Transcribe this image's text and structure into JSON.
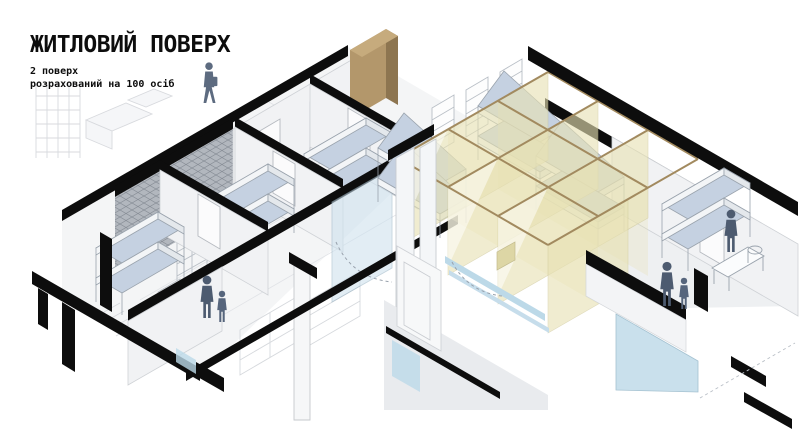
{
  "header": {
    "title": "ЖИТЛОВИЙ ПОВЕРХ",
    "subtitle_line1": "2 поверх",
    "subtitle_line2": "розрахований на 100 осіб"
  },
  "palette": {
    "ink": "#0d0d0d",
    "wall_light": "#f1f2f4",
    "wall_shade": "#e3e5e9",
    "hatch_base": "#b2b7be",
    "mattress": "#c5d1e1",
    "bed_frame": "#f3f5f7",
    "bed_side": "#e4e8ec",
    "fabric_yellow": "#e8e2b4",
    "rail_brown": "#a28a5f",
    "wood_brown": "#b3976b",
    "wood_dark": "#8d7550",
    "glass_blue": "#bcd9e8",
    "figure": "#4d5b70",
    "sketch": "#d8dade",
    "outline": "#b9bfc6"
  }
}
